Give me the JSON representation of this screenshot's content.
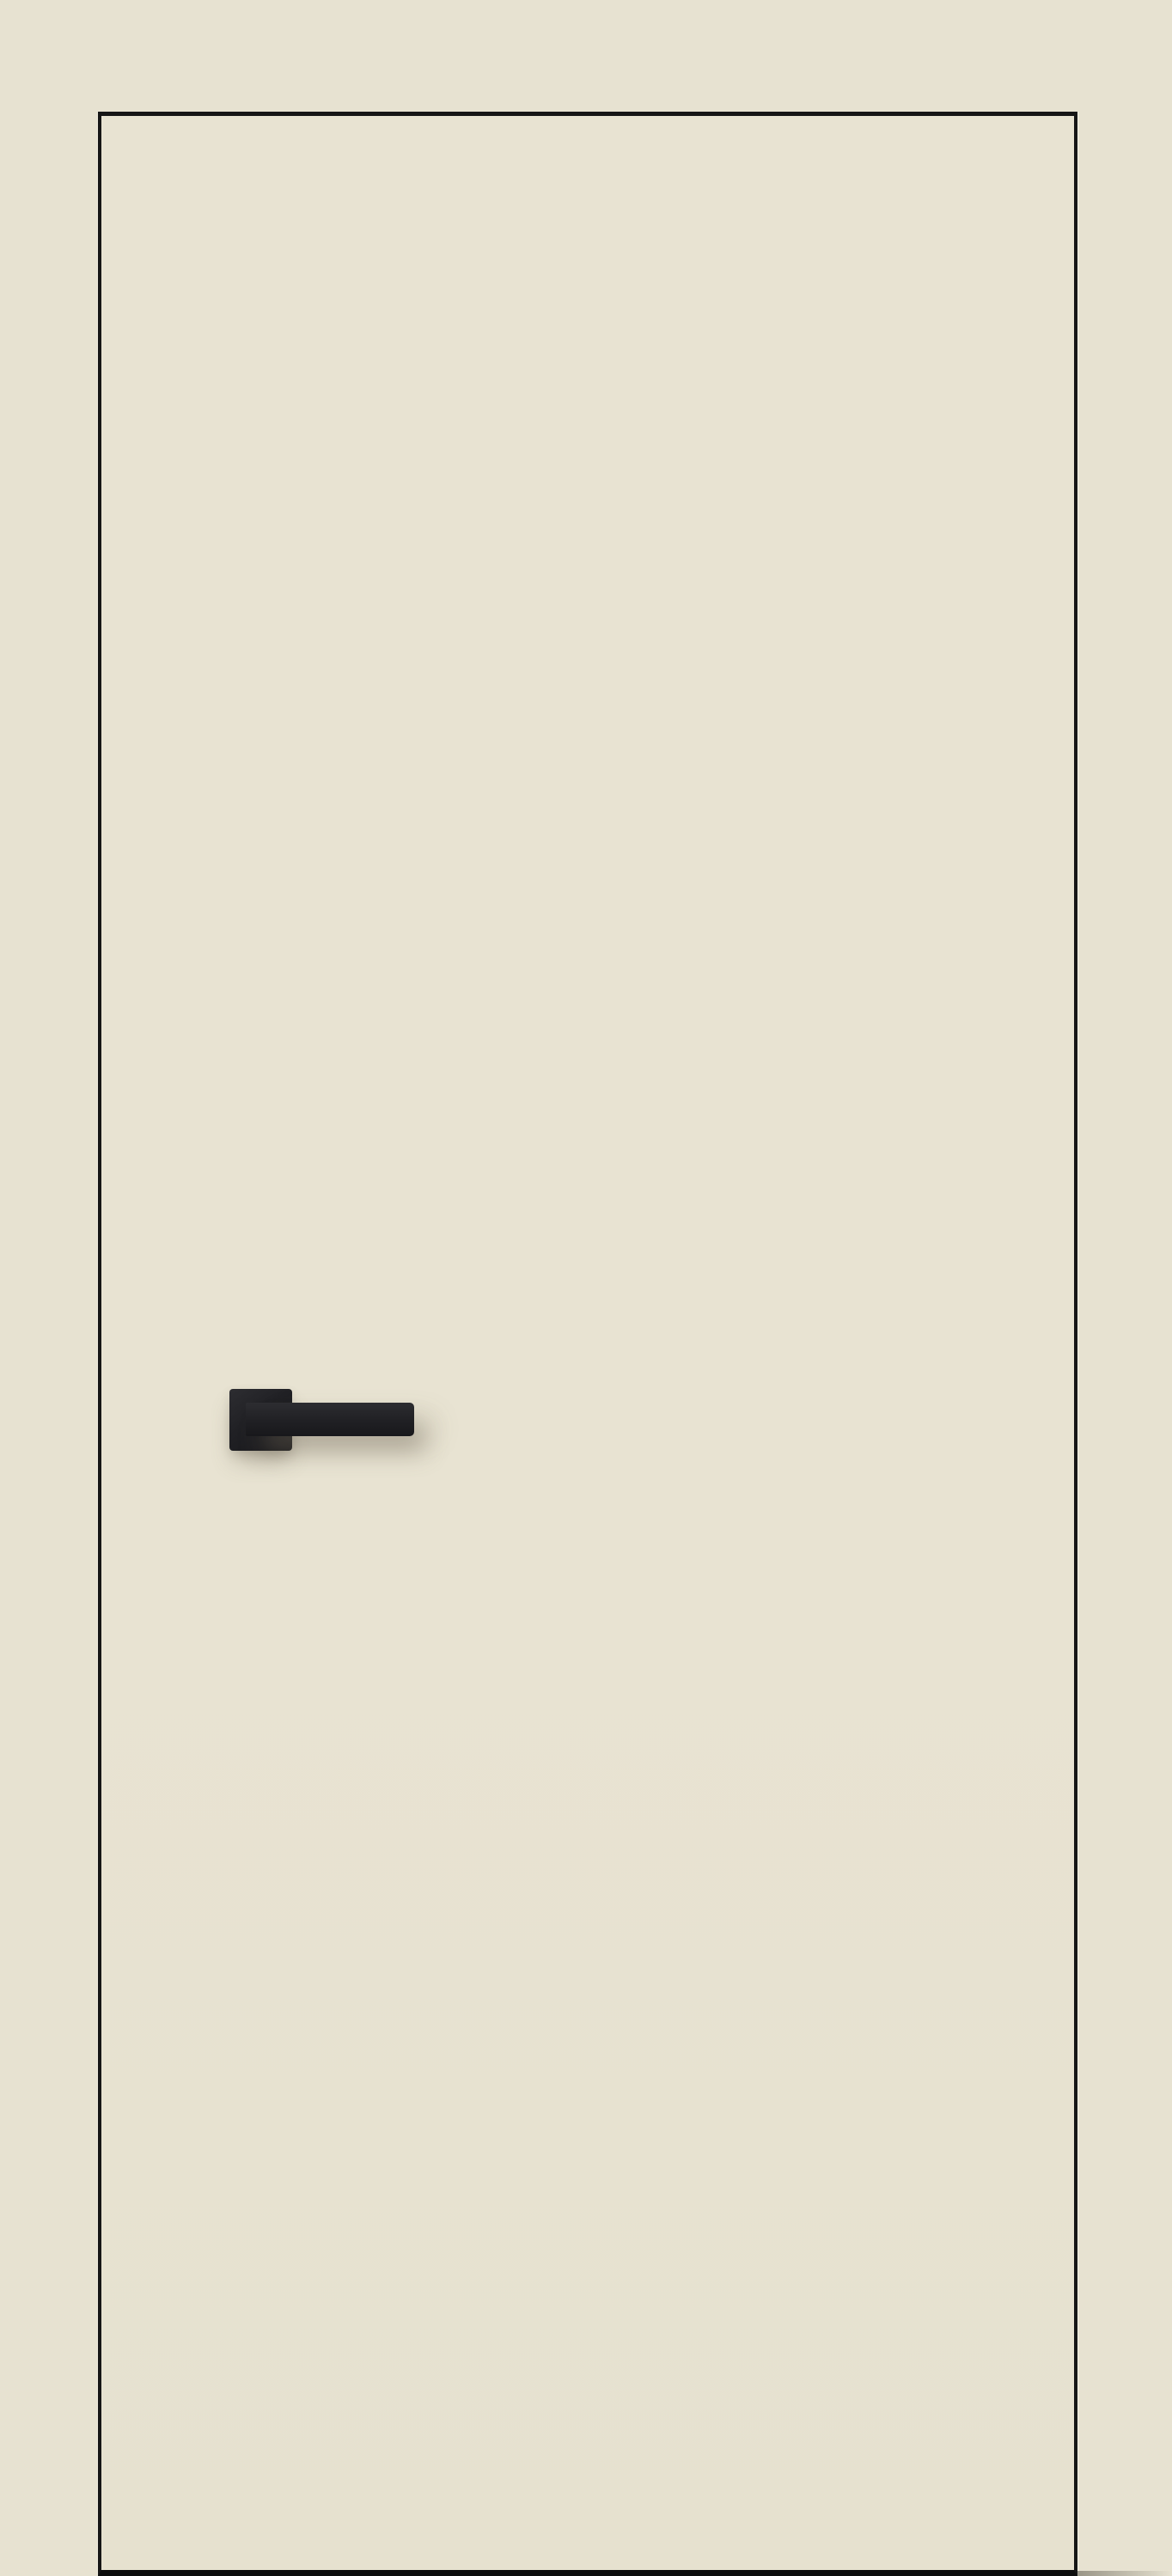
{
  "image": {
    "subject": "flush interior door with cream finish, thin black edge outline, and a black rectangular lever handle on a square rosette",
    "text_content": "none"
  },
  "colors": {
    "background": "#e7e2d1",
    "door_fill": "#e8e3d2",
    "door_outline": "#161616",
    "door_bottom_edge": "#0d0d0d",
    "handle_base": "#202024",
    "handle_highlight": "#2d2d31",
    "handle_deep": "#18181b",
    "shadow_soft": "rgba(112,105,88,0.45)",
    "shadow_faint": "rgba(112,105,88,0.25)"
  }
}
